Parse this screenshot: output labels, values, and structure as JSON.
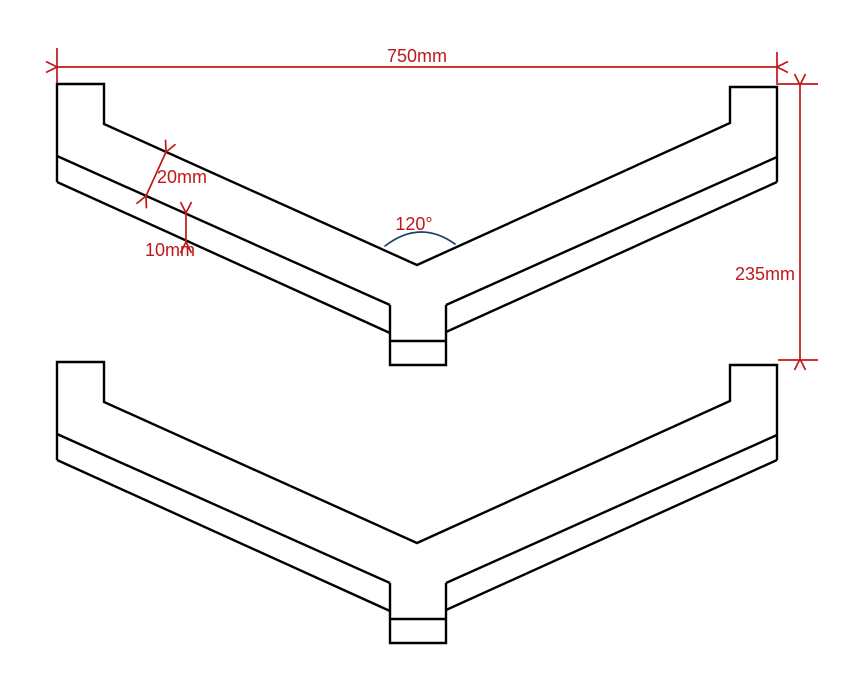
{
  "colors": {
    "background": "#ffffff",
    "outline": "#000000",
    "dimension": "#c01818",
    "angle_arc": "#1f3f66"
  },
  "drawing": {
    "description": "Front elevation of two identical V-bent plate profiles with end tabs and a center bottom tab",
    "labels": {
      "overall_width": "750mm",
      "overall_height": "235mm",
      "upper_plate_thickness": "20mm",
      "lower_plate_thickness": "10mm",
      "bend_angle": "120°"
    }
  }
}
